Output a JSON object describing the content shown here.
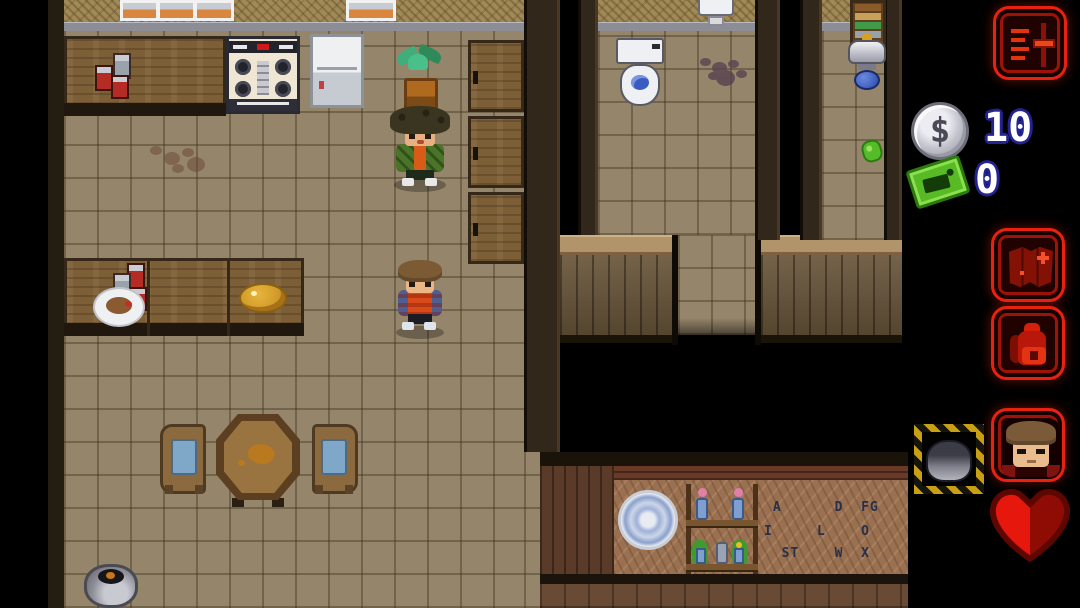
{
  "hud": {
    "settings_button": {
      "icon": "settings-sliders-icon"
    },
    "money": {
      "icon": "dollar-coin-icon",
      "glyph": "$",
      "value": "10"
    },
    "tickets": {
      "icon": "ticket-icon",
      "value": "0"
    },
    "map_button": {
      "icon": "map-icon"
    },
    "inventory_button": {
      "icon": "backpack-icon"
    },
    "character_button": {
      "icon": "character-portrait-icon"
    },
    "health": {
      "icon": "heart-icon",
      "color_left": "#e6170c",
      "color_right": "#8e0c04"
    },
    "colors": {
      "hud_red": "#e92110",
      "coin_silver": "#c2c2cc",
      "ticket_green": "#58ba24",
      "value_text": "#ffffff",
      "value_outline": "#232394"
    }
  },
  "scene": {
    "characters": [
      {
        "name": "kid-green-jacket"
      },
      {
        "name": "kid-striped-shirt"
      }
    ],
    "objects": [
      "window",
      "stove",
      "refrigerator",
      "kitchen-counter",
      "canned-goods",
      "potted-plant",
      "wall-cabinets",
      "meal-plate",
      "food-pile",
      "dining-table",
      "chair",
      "cooking-pot",
      "toilet",
      "sink",
      "floor-stain",
      "bookshelf",
      "lamp",
      "green-collectible",
      "hazard-rock",
      "decorative-plate",
      "flower-shelf",
      "alphabet-wall"
    ],
    "alphabet_wall": {
      "rows": [
        " A      D  FG",
        "I     L    O",
        "  ST    W  X"
      ]
    }
  }
}
